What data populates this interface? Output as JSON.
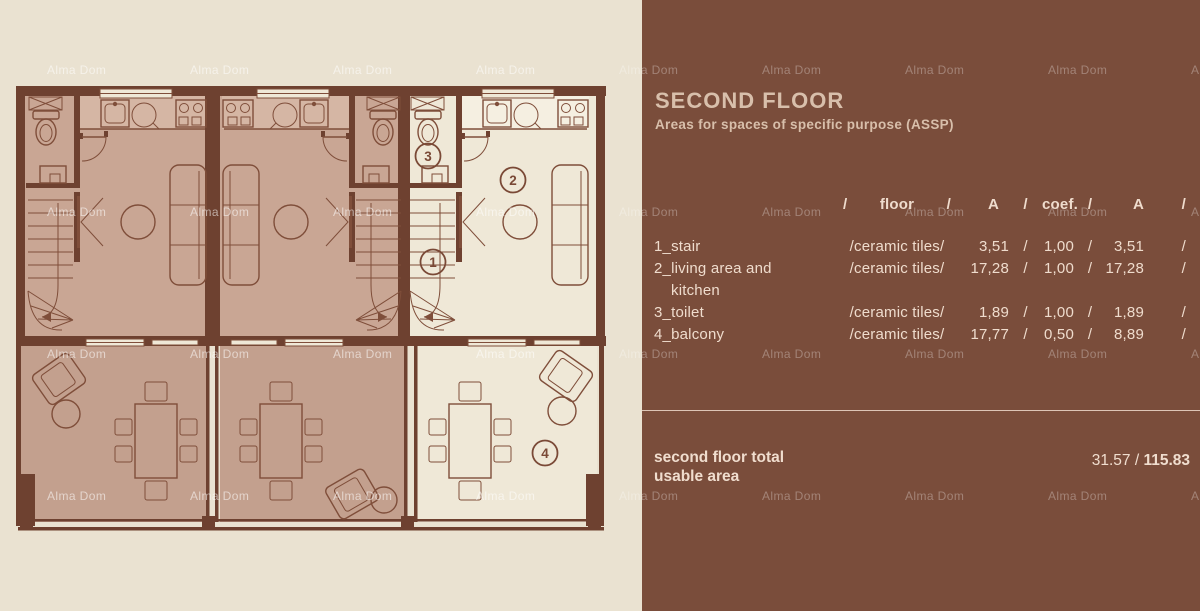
{
  "watermark": {
    "text": "Alma Dom"
  },
  "plan": {
    "markers": [
      {
        "label": "1"
      },
      {
        "label": "2"
      },
      {
        "label": "3"
      },
      {
        "label": "4"
      }
    ]
  },
  "panel": {
    "title": "SECOND FLOOR",
    "subtitle": "Areas for spaces of specific purpose (ASSP)",
    "table": {
      "slash": "/",
      "header": {
        "floor": "floor",
        "a": "A",
        "coef": "coef.",
        "a2": "A"
      },
      "rows": [
        {
          "name": "1_stair",
          "name2": "",
          "material": "/ceramic tiles/",
          "a": "3,51",
          "coef": "1,00",
          "result": "3,51"
        },
        {
          "name": "2_living area and",
          "name2": "kitchen",
          "material": "/ceramic tiles/",
          "a": "17,28",
          "coef": "1,00",
          "result": "17,28"
        },
        {
          "name": "3_toilet",
          "name2": "",
          "material": "/ceramic tiles/",
          "a": "1,89",
          "coef": "1,00",
          "result": "1,89"
        },
        {
          "name": "4_balcony",
          "name2": "",
          "material": "/ceramic tiles/",
          "a": "17,77",
          "coef": "0,50",
          "result": "8,89"
        }
      ]
    },
    "total": {
      "label_line1": "second floor total",
      "label_line2": "usable area",
      "value_regular": "31.57 / ",
      "value_bold": "115.83"
    },
    "colors": {
      "page_bg": "#EAE2D1",
      "panel_bg": "#7A4D3B",
      "wall": "#6E4130",
      "unit_fill": "#C9A694",
      "balcony_fill": "#C3A08E",
      "highlight_fill": "#EFE8D7",
      "table_text": "#EFDCCD",
      "title_text": "#D8BFAB"
    }
  }
}
